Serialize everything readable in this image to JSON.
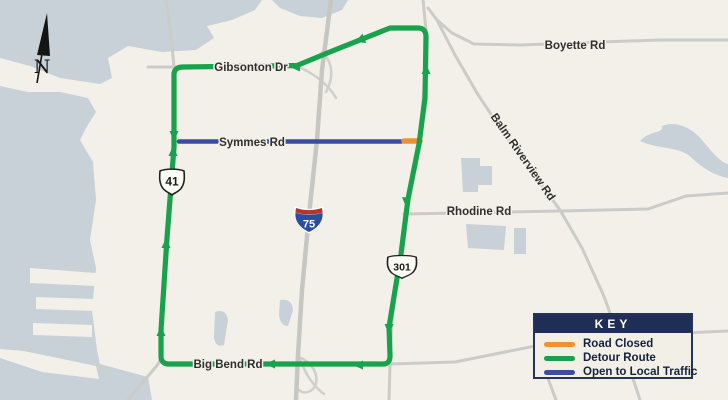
{
  "map": {
    "compass": {
      "north_label": "N"
    },
    "road_labels": {
      "gibsonton": "Gibsonton Dr",
      "boyette": "Boyette Rd",
      "symmes": "Symmes Rd",
      "balm_riverview": "Balm Riverview Rd",
      "rhodine": "Rhodine Rd",
      "big_bend": "Big Bend Rd"
    },
    "route_shields": {
      "us41": "41",
      "i75": "75",
      "us301": "301"
    },
    "colors": {
      "road_closed": "#f0912e",
      "detour_route": "#18a24b",
      "open_to_local_traffic": "#3a4da0",
      "water": "#c7d1d7",
      "land": "#f2f0e9",
      "minor_road": "#cbcbc7",
      "legend_navy": "#1f2e54",
      "interstate_red": "#b5342c",
      "interstate_blue": "#2b4f9e"
    }
  },
  "legend": {
    "title": "KEY",
    "items": [
      {
        "label": "Road Closed"
      },
      {
        "label": "Detour Route"
      },
      {
        "label": "Open to Local Traffic"
      }
    ]
  }
}
